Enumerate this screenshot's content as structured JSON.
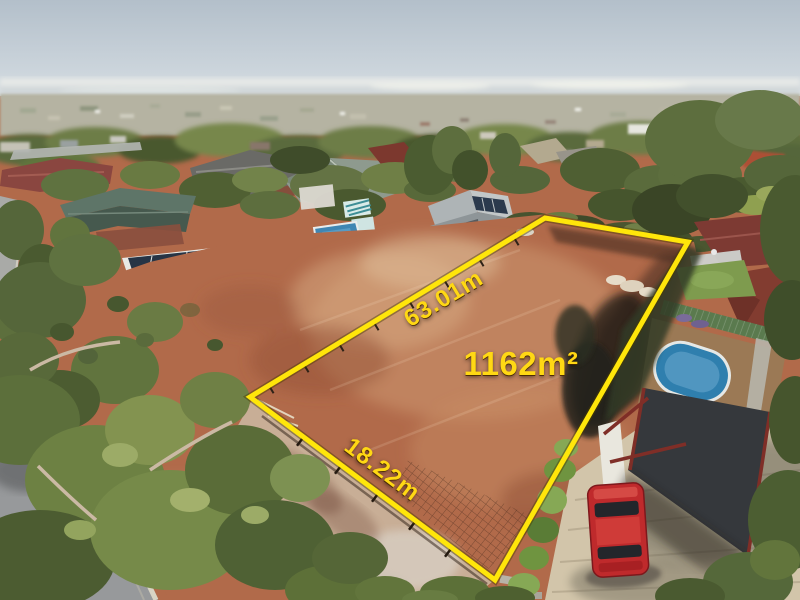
{
  "image": {
    "width": 800,
    "height": 600
  },
  "annotations": {
    "side_length": "63.01m",
    "frontage": "18.22m",
    "area": "1162m²"
  },
  "palette": {
    "boundary_yellow": "#FFE60A",
    "label_yellow": "#FFD814",
    "earth_red": "#B16A4A",
    "earth_light": "#D3A37B",
    "sky_top": "#B3BFCA",
    "sky_horizon": "#DDE2E4",
    "tree_green": "#5A6B3C",
    "lawn_green": "#7E9B4E",
    "pool_blue": "#2F7FAE",
    "roof_maroon": "#7D3A33",
    "roof_sage": "#8E9A8E",
    "shed_grey": "#9BA1A3",
    "car_red": "#BF2A2C",
    "carport_charcoal": "#35383C",
    "driveway_tan": "#D2C5AA",
    "road_grey": "#97999B",
    "kerb": "#D8D4C4"
  },
  "scene": {
    "objects": [
      "vacant-lot",
      "boundary-outline",
      "grey-shed-solar",
      "suburban-houses",
      "backyard-pool-left",
      "neighbor-pool-right",
      "carport",
      "red-car",
      "paved-driveway",
      "street-kerb",
      "eucalyptus-trees",
      "distant-suburbs",
      "sky"
    ]
  }
}
